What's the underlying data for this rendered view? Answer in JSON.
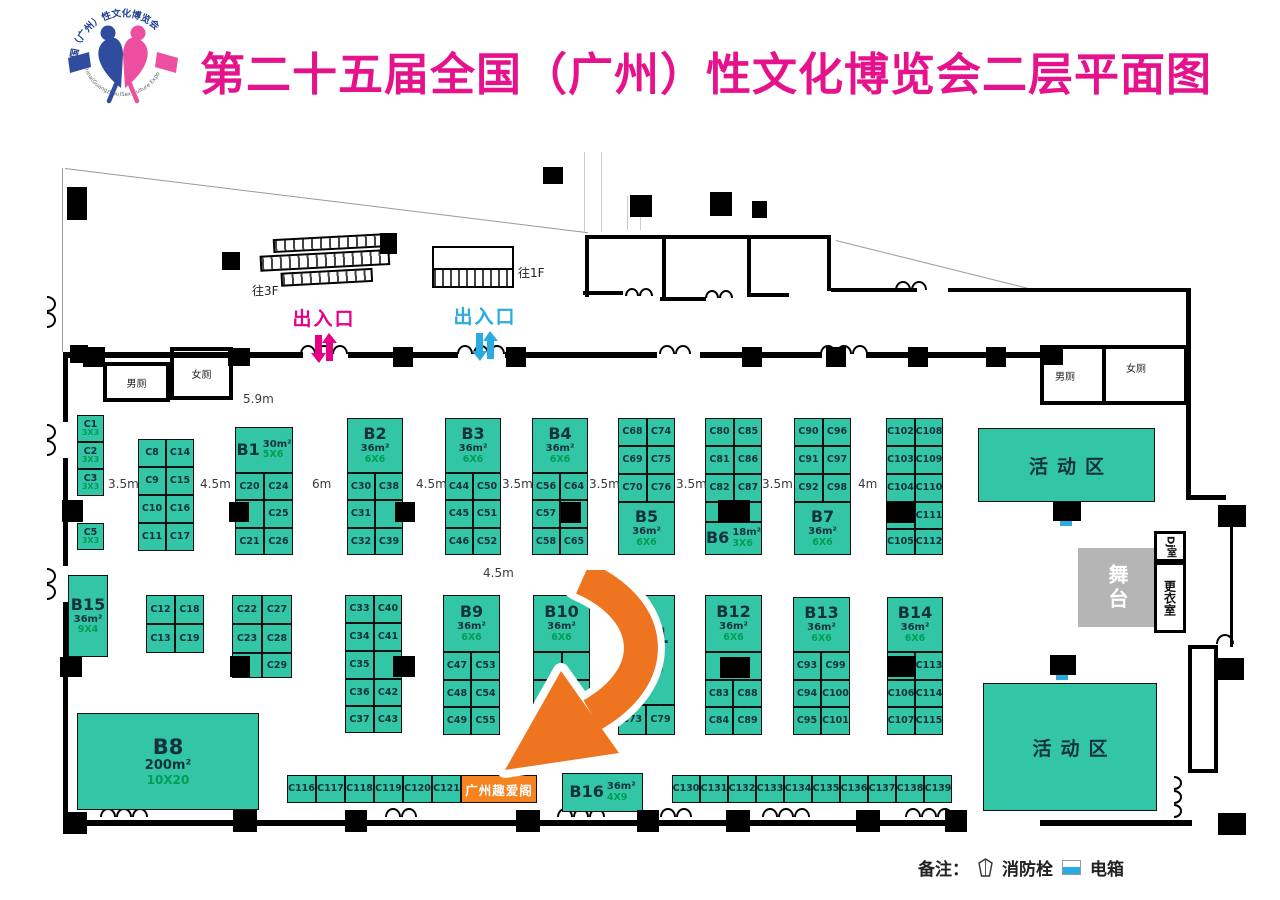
{
  "title": "第二十五届全国（广州）性文化博览会二层平面图",
  "logo": {
    "top_arc": "全国（广州）性文化博览会",
    "bottom_arc": "China(Guangzhou)Sex Culture Expo"
  },
  "colors": {
    "title": "#E6128C",
    "booth": "#33C6A6",
    "booth_text": "#14323C",
    "size_text": "#009E54",
    "orange": "#F5831F",
    "arrow": "#EE7420",
    "entrance_left": "#E60085",
    "entrance_right": "#29ABE2",
    "stage_gray": "#B5B5B5",
    "electric_cyan": "#29ABE2"
  },
  "entrances": {
    "left": {
      "label": "出入口",
      "color": "#E60085"
    },
    "right": {
      "label": "出入口",
      "color": "#29ABE2"
    }
  },
  "stairs": {
    "left": "往3F",
    "right": "往1F"
  },
  "rooms": {
    "men_left": "男厕",
    "women_left": "女厕",
    "men_right": "男厕",
    "women_right": "女厕",
    "stage": "舞台",
    "dj": "Dj室",
    "changing": "更衣室"
  },
  "legend": {
    "label": "备注：",
    "fire": "消防栓",
    "electric": "电箱"
  },
  "dimensions": [
    [
      "5.9m",
      243,
      392
    ],
    [
      "3.5m",
      108,
      477
    ],
    [
      "4.5m",
      200,
      477
    ],
    [
      "6m",
      312,
      477
    ],
    [
      "4.5m",
      416,
      477
    ],
    [
      "3.5m",
      502,
      477
    ],
    [
      "3.5m",
      589,
      477
    ],
    [
      "3.5m",
      676,
      477
    ],
    [
      "3.5m",
      762,
      477
    ],
    [
      "4m",
      858,
      477
    ],
    [
      "4.5m",
      483,
      566
    ]
  ],
  "booths": [
    [
      "C1",
      77,
      415,
      27,
      27,
      0,
      "3X3"
    ],
    [
      "C2",
      77,
      442,
      27,
      27,
      0,
      "3X3"
    ],
    [
      "C3",
      77,
      469,
      27,
      27,
      0,
      "3X3"
    ],
    [
      "C5",
      77,
      523,
      27,
      27,
      0,
      "3X3"
    ],
    [
      "C8",
      138,
      439,
      28,
      28,
      0
    ],
    [
      "C14",
      166,
      439,
      28,
      28,
      0
    ],
    [
      "C9",
      138,
      467,
      28,
      28,
      0
    ],
    [
      "C15",
      166,
      467,
      28,
      28,
      0
    ],
    [
      "C10",
      138,
      495,
      28,
      28,
      0
    ],
    [
      "C16",
      166,
      495,
      28,
      28,
      0
    ],
    [
      "C11",
      138,
      523,
      28,
      28,
      0
    ],
    [
      "C17",
      166,
      523,
      28,
      28,
      0
    ],
    [
      "B1",
      235,
      427,
      58,
      46,
      2,
      "30m²",
      "5X6"
    ],
    [
      "C20",
      235,
      473,
      29,
      27,
      0
    ],
    [
      "C24",
      264,
      473,
      29,
      27,
      0
    ],
    [
      "",
      235,
      500,
      29,
      28,
      3
    ],
    [
      "C25",
      264,
      500,
      29,
      28,
      0
    ],
    [
      "C21",
      235,
      528,
      29,
      27,
      0
    ],
    [
      "C26",
      264,
      528,
      29,
      27,
      0
    ],
    [
      "B2",
      347,
      418,
      56,
      55,
      1,
      "36m²",
      "6X6"
    ],
    [
      "C30",
      347,
      473,
      28,
      27,
      0
    ],
    [
      "C38",
      375,
      473,
      28,
      27,
      0
    ],
    [
      "C31",
      347,
      500,
      28,
      28,
      0
    ],
    [
      "",
      375,
      500,
      28,
      28,
      3
    ],
    [
      "C32",
      347,
      528,
      28,
      27,
      0
    ],
    [
      "C39",
      375,
      528,
      28,
      27,
      0
    ],
    [
      "B3",
      445,
      418,
      56,
      55,
      1,
      "36m²",
      "6X6"
    ],
    [
      "C44",
      445,
      473,
      28,
      27,
      0
    ],
    [
      "C50",
      473,
      473,
      28,
      27,
      0
    ],
    [
      "C45",
      445,
      500,
      28,
      28,
      0
    ],
    [
      "C51",
      473,
      500,
      28,
      28,
      0
    ],
    [
      "C46",
      445,
      528,
      28,
      27,
      0
    ],
    [
      "C52",
      473,
      528,
      28,
      27,
      0
    ],
    [
      "B4",
      532,
      418,
      56,
      55,
      1,
      "36m²",
      "6X6"
    ],
    [
      "C56",
      532,
      473,
      28,
      27,
      0
    ],
    [
      "C64",
      560,
      473,
      28,
      27,
      0
    ],
    [
      "C57",
      532,
      500,
      28,
      28,
      0
    ],
    [
      "",
      560,
      500,
      28,
      28,
      3
    ],
    [
      "C58",
      532,
      528,
      28,
      27,
      0
    ],
    [
      "C65",
      560,
      528,
      28,
      27,
      0
    ],
    [
      "C68",
      618,
      418,
      29,
      28,
      0
    ],
    [
      "C74",
      647,
      418,
      28,
      28,
      0
    ],
    [
      "C69",
      618,
      446,
      29,
      28,
      0
    ],
    [
      "C75",
      647,
      446,
      28,
      28,
      0
    ],
    [
      "C70",
      618,
      474,
      29,
      28,
      0
    ],
    [
      "C76",
      647,
      474,
      28,
      28,
      0
    ],
    [
      "B5",
      618,
      502,
      57,
      53,
      1,
      "36m²",
      "6X6"
    ],
    [
      "C80",
      705,
      418,
      29,
      28,
      0
    ],
    [
      "C85",
      734,
      418,
      28,
      28,
      0
    ],
    [
      "C81",
      705,
      446,
      29,
      28,
      0
    ],
    [
      "C86",
      734,
      446,
      28,
      28,
      0
    ],
    [
      "C82",
      705,
      474,
      29,
      28,
      0
    ],
    [
      "C87",
      734,
      474,
      28,
      28,
      0
    ],
    [
      "",
      705,
      502,
      57,
      20,
      3
    ],
    [
      "B6",
      705,
      522,
      57,
      33,
      2,
      "18m²",
      "3X6"
    ],
    [
      "C90",
      794,
      418,
      29,
      28,
      0
    ],
    [
      "C96",
      823,
      418,
      28,
      28,
      0
    ],
    [
      "C91",
      794,
      446,
      29,
      28,
      0
    ],
    [
      "C97",
      823,
      446,
      28,
      28,
      0
    ],
    [
      "C92",
      794,
      474,
      29,
      28,
      0
    ],
    [
      "C98",
      823,
      474,
      28,
      28,
      0
    ],
    [
      "B7",
      794,
      502,
      57,
      53,
      1,
      "36m²",
      "6X6"
    ],
    [
      "C102",
      886,
      418,
      29,
      28,
      0
    ],
    [
      "C108",
      915,
      418,
      28,
      28,
      0
    ],
    [
      "C103",
      886,
      446,
      29,
      28,
      0
    ],
    [
      "C109",
      915,
      446,
      28,
      28,
      0
    ],
    [
      "C104",
      886,
      474,
      29,
      28,
      0
    ],
    [
      "C110",
      915,
      474,
      28,
      28,
      0
    ],
    [
      "",
      886,
      502,
      29,
      27,
      3
    ],
    [
      "C111",
      915,
      502,
      28,
      27,
      0
    ],
    [
      "C105",
      886,
      529,
      29,
      26,
      0
    ],
    [
      "C112",
      915,
      529,
      28,
      26,
      0
    ],
    [
      "B15",
      68,
      575,
      40,
      82,
      1,
      "36m²",
      "9X4"
    ],
    [
      "C12",
      146,
      595,
      29,
      29,
      0
    ],
    [
      "C18",
      175,
      595,
      29,
      29,
      0
    ],
    [
      "C13",
      146,
      624,
      29,
      29,
      0
    ],
    [
      "C19",
      175,
      624,
      29,
      29,
      0
    ],
    [
      "C22",
      232,
      595,
      30,
      29,
      0
    ],
    [
      "C27",
      262,
      595,
      30,
      29,
      0
    ],
    [
      "C23",
      232,
      624,
      30,
      29,
      0
    ],
    [
      "C28",
      262,
      624,
      30,
      29,
      0
    ],
    [
      "",
      232,
      653,
      30,
      25,
      3
    ],
    [
      "C29",
      262,
      653,
      30,
      25,
      0
    ],
    [
      "C33",
      345,
      595,
      29,
      28,
      0
    ],
    [
      "C40",
      374,
      595,
      28,
      28,
      0
    ],
    [
      "C34",
      345,
      623,
      29,
      28,
      0
    ],
    [
      "C41",
      374,
      623,
      28,
      28,
      0
    ],
    [
      "C35",
      345,
      651,
      29,
      28,
      0
    ],
    [
      "",
      374,
      651,
      28,
      28,
      3
    ],
    [
      "C36",
      345,
      679,
      29,
      27,
      0
    ],
    [
      "C42",
      374,
      679,
      28,
      27,
      0
    ],
    [
      "C37",
      345,
      706,
      29,
      27,
      0
    ],
    [
      "C43",
      374,
      706,
      28,
      27,
      0
    ],
    [
      "B8",
      77,
      713,
      182,
      97,
      1,
      "200m²",
      "10X20"
    ],
    [
      "B9",
      443,
      595,
      57,
      57,
      1,
      "36m²",
      "6X6"
    ],
    [
      "C47",
      443,
      652,
      28,
      28,
      0
    ],
    [
      "C53",
      471,
      652,
      29,
      28,
      0
    ],
    [
      "C48",
      443,
      680,
      28,
      27,
      0
    ],
    [
      "C54",
      471,
      680,
      29,
      27,
      0
    ],
    [
      "C49",
      443,
      707,
      28,
      28,
      0
    ],
    [
      "C55",
      471,
      707,
      29,
      28,
      0
    ],
    [
      "B10",
      533,
      595,
      57,
      57,
      1,
      "36m²",
      "6X6"
    ],
    [
      "",
      533,
      652,
      29,
      28,
      3
    ],
    [
      "",
      562,
      652,
      28,
      28,
      3
    ],
    [
      "",
      533,
      680,
      29,
      27,
      3
    ],
    [
      "",
      562,
      680,
      28,
      27,
      3
    ],
    [
      "",
      533,
      707,
      29,
      28,
      3
    ],
    [
      "",
      562,
      707,
      28,
      28,
      3
    ],
    [
      "B11",
      618,
      595,
      57,
      110,
      1,
      "72m²",
      "12X6"
    ],
    [
      "C73",
      618,
      705,
      28,
      30,
      0
    ],
    [
      "C79",
      646,
      705,
      29,
      30,
      0
    ],
    [
      "B12",
      705,
      595,
      57,
      57,
      1,
      "36m²",
      "6X6"
    ],
    [
      "",
      705,
      652,
      57,
      28,
      3
    ],
    [
      "C83",
      705,
      680,
      28,
      27,
      0
    ],
    [
      "C88",
      733,
      680,
      29,
      27,
      0
    ],
    [
      "C84",
      705,
      707,
      28,
      28,
      0
    ],
    [
      "C89",
      733,
      707,
      29,
      28,
      0
    ],
    [
      "B13",
      793,
      597,
      57,
      55,
      1,
      "36m²",
      "6X6"
    ],
    [
      "C93",
      793,
      652,
      28,
      28,
      0
    ],
    [
      "C99",
      821,
      652,
      29,
      28,
      0
    ],
    [
      "C94",
      793,
      680,
      28,
      27,
      0
    ],
    [
      "C100",
      821,
      680,
      29,
      27,
      0
    ],
    [
      "C95",
      793,
      707,
      28,
      28,
      0
    ],
    [
      "C101",
      821,
      707,
      29,
      28,
      0
    ],
    [
      "B14",
      887,
      597,
      56,
      55,
      1,
      "36m²",
      "6X6"
    ],
    [
      "",
      887,
      652,
      28,
      28,
      3
    ],
    [
      "C113",
      915,
      652,
      28,
      28,
      0
    ],
    [
      "C106",
      887,
      680,
      28,
      27,
      0
    ],
    [
      "C114",
      915,
      680,
      28,
      27,
      0
    ],
    [
      "C107",
      887,
      707,
      28,
      28,
      0
    ],
    [
      "C115",
      915,
      707,
      28,
      28,
      0
    ],
    [
      "C116",
      287,
      775,
      29,
      28,
      0
    ],
    [
      "C117",
      316,
      775,
      29,
      28,
      0
    ],
    [
      "C118",
      345,
      775,
      29,
      28,
      0
    ],
    [
      "C119",
      374,
      775,
      29,
      28,
      0
    ],
    [
      "C120",
      403,
      775,
      29,
      28,
      0
    ],
    [
      "C121",
      432,
      775,
      29,
      28,
      0
    ],
    [
      "广州趣爱阁",
      461,
      775,
      76,
      28,
      4
    ],
    [
      "B16",
      562,
      773,
      81,
      39,
      2,
      "36m²",
      "4X9"
    ],
    [
      "C130",
      672,
      775,
      28,
      28,
      0
    ],
    [
      "C131",
      700,
      775,
      28,
      28,
      0
    ],
    [
      "C132",
      728,
      775,
      28,
      28,
      0
    ],
    [
      "C133",
      756,
      775,
      28,
      28,
      0
    ],
    [
      "C134",
      784,
      775,
      28,
      28,
      0
    ],
    [
      "C135",
      812,
      775,
      28,
      28,
      0
    ],
    [
      "C136",
      840,
      775,
      28,
      28,
      0
    ],
    [
      "C137",
      868,
      775,
      28,
      28,
      0
    ],
    [
      "C138",
      896,
      775,
      28,
      28,
      0
    ],
    [
      "C139",
      924,
      775,
      28,
      28,
      0
    ],
    [
      "活动区",
      978,
      428,
      177,
      74,
      5
    ],
    [
      "活动区",
      983,
      683,
      174,
      128,
      5
    ]
  ],
  "floorplan": {
    "lines": [
      [
        65,
        168,
        527,
        7,
        "#999"
      ],
      [
        836,
        240,
        204,
        14,
        "#999"
      ],
      [
        63,
        168,
        184,
        90,
        "#999"
      ],
      [
        585,
        152,
        80,
        90,
        "#ccc"
      ],
      [
        602,
        152,
        80,
        90,
        "#ccc"
      ],
      [
        628,
        196,
        34,
        90,
        "#ccc"
      ],
      [
        641,
        196,
        34,
        90,
        "#ccc"
      ]
    ],
    "walls": [
      [
        63,
        352,
        5,
        70
      ],
      [
        63,
        458,
        5,
        108
      ],
      [
        63,
        602,
        5,
        222
      ],
      [
        63,
        352,
        240,
        6
      ],
      [
        348,
        352,
        110,
        6
      ],
      [
        505,
        352,
        152,
        6
      ],
      [
        700,
        352,
        122,
        6
      ],
      [
        866,
        352,
        174,
        6
      ],
      [
        585,
        235,
        246,
        4
      ],
      [
        585,
        235,
        4,
        62
      ],
      [
        662,
        235,
        4,
        66
      ],
      [
        747,
        235,
        4,
        62
      ],
      [
        827,
        235,
        4,
        56
      ],
      [
        583,
        291,
        40,
        4
      ],
      [
        660,
        297,
        46,
        4
      ],
      [
        747,
        293,
        42,
        4
      ],
      [
        831,
        288,
        86,
        4
      ],
      [
        948,
        288,
        242,
        4
      ],
      [
        1186,
        288,
        5,
        212
      ],
      [
        1186,
        495,
        40,
        5
      ],
      [
        1230,
        527,
        3,
        120
      ],
      [
        1130,
        820,
        62,
        6
      ],
      [
        63,
        820,
        890,
        6
      ],
      [
        1040,
        820,
        150,
        6
      ],
      [
        1102,
        345,
        4,
        60
      ]
    ],
    "pillars": [
      [
        67,
        187,
        20,
        33
      ],
      [
        222,
        252,
        18,
        18
      ],
      [
        380,
        233,
        17,
        21
      ],
      [
        543,
        167,
        20,
        17
      ],
      [
        630,
        195,
        22,
        22
      ],
      [
        710,
        192,
        22,
        24
      ],
      [
        752,
        201,
        15,
        17
      ],
      [
        70,
        345,
        18,
        18
      ],
      [
        83,
        347,
        22,
        20
      ],
      [
        228,
        348,
        22,
        18
      ],
      [
        393,
        347,
        20,
        20
      ],
      [
        506,
        347,
        20,
        20
      ],
      [
        742,
        347,
        20,
        20
      ],
      [
        826,
        347,
        20,
        20
      ],
      [
        908,
        347,
        20,
        20
      ],
      [
        986,
        347,
        20,
        20
      ],
      [
        1040,
        348,
        23,
        17
      ],
      [
        62,
        500,
        21,
        22
      ],
      [
        229,
        502,
        20,
        20
      ],
      [
        395,
        502,
        20,
        20
      ],
      [
        561,
        502,
        20,
        21
      ],
      [
        718,
        500,
        32,
        22
      ],
      [
        886,
        502,
        29,
        21
      ],
      [
        60,
        657,
        22,
        20
      ],
      [
        230,
        656,
        20,
        21
      ],
      [
        393,
        656,
        22,
        21
      ],
      [
        720,
        657,
        30,
        21
      ],
      [
        887,
        656,
        29,
        21
      ],
      [
        1053,
        502,
        28,
        19
      ],
      [
        1050,
        655,
        26,
        20
      ],
      [
        1218,
        505,
        28,
        22
      ],
      [
        1216,
        658,
        28,
        22
      ],
      [
        63,
        812,
        24,
        22
      ],
      [
        233,
        810,
        24,
        22
      ],
      [
        345,
        810,
        22,
        22
      ],
      [
        516,
        810,
        24,
        22
      ],
      [
        637,
        810,
        22,
        22
      ],
      [
        726,
        810,
        24,
        22
      ],
      [
        856,
        810,
        24,
        22
      ],
      [
        945,
        810,
        22,
        22
      ],
      [
        1218,
        813,
        28,
        22
      ]
    ],
    "cyan_marks": [
      [
        1060,
        521,
        12,
        5
      ],
      [
        1056,
        675,
        12,
        5
      ]
    ],
    "arcs": [
      [
        300,
        345,
        3,
        16,
        0
      ],
      [
        457,
        345,
        3,
        16,
        0
      ],
      [
        659,
        345,
        2,
        16,
        0
      ],
      [
        820,
        345,
        3,
        16,
        0
      ],
      [
        625,
        288,
        2,
        14,
        0
      ],
      [
        705,
        290,
        2,
        14,
        0
      ],
      [
        895,
        281,
        2,
        16,
        0
      ],
      [
        100,
        808,
        3,
        16,
        0
      ],
      [
        385,
        808,
        2,
        16,
        0
      ],
      [
        557,
        808,
        3,
        16,
        0
      ],
      [
        660,
        808,
        2,
        16,
        0
      ],
      [
        762,
        808,
        3,
        16,
        0
      ],
      [
        905,
        808,
        3,
        16,
        0
      ],
      [
        56,
        296,
        2,
        16,
        90
      ],
      [
        56,
        424,
        2,
        16,
        90
      ],
      [
        56,
        568,
        2,
        16,
        90
      ],
      [
        1182,
        776,
        3,
        14,
        90
      ],
      [
        1216,
        634,
        1,
        18,
        0
      ]
    ]
  }
}
